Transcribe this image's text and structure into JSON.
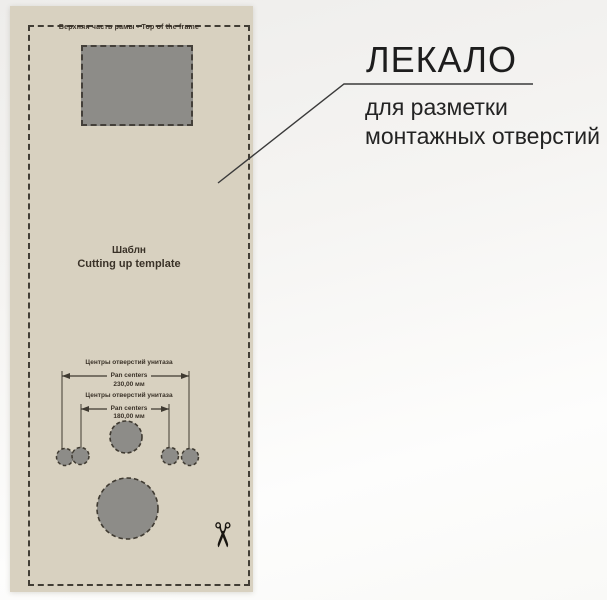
{
  "template": {
    "top_label": "Верхняя часть рамы - Top of the frame",
    "name_ru": "Шаблн",
    "name_en": "Cutting up template",
    "dimensions": [
      {
        "label_ru": "Центры отверстий унитаза",
        "label_en": "Pan centers",
        "value": "230,00 мм"
      },
      {
        "label_ru": "Центры отверстий унитаза",
        "label_en": "Pan centers",
        "value": "180,00 мм"
      }
    ],
    "colors": {
      "paper": "#d8d1c0",
      "hole_fill": "#8d8c88",
      "cut_line": "#413d35"
    }
  },
  "callout": {
    "title": "ЛЕКАЛО",
    "subtitle": [
      "для разметки",
      "монтажных отверстий"
    ]
  },
  "icons": {
    "scissors": "✂"
  }
}
